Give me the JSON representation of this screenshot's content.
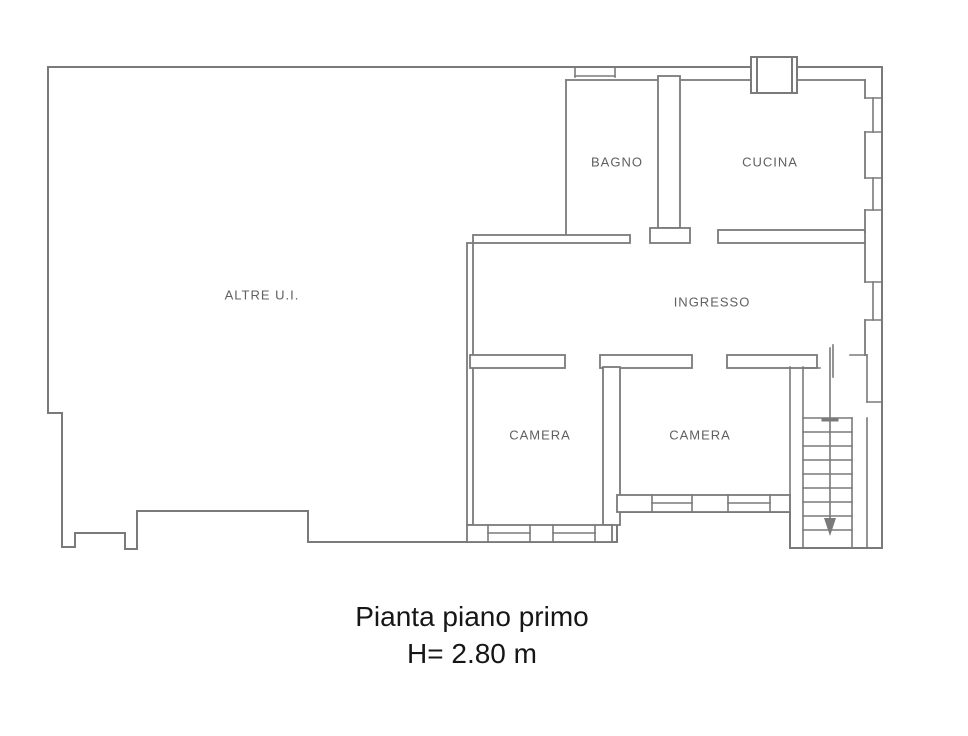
{
  "floor_plan": {
    "rooms": [
      {
        "name": "altre-ui",
        "label": "ALTRE U.I."
      },
      {
        "name": "bagno",
        "label": "BAGNO"
      },
      {
        "name": "cucina",
        "label": "CUCINA"
      },
      {
        "name": "ingresso",
        "label": "INGRESSO"
      },
      {
        "name": "camera-left",
        "label": "CAMERA"
      },
      {
        "name": "camera-right",
        "label": "CAMERA"
      }
    ],
    "caption": {
      "title": "Pianta piano primo",
      "height_note": "H= 2.80 m"
    },
    "colors": {
      "wall_line": "#7a7a7a",
      "room_label": "#606060",
      "caption_text": "#161616",
      "background": "#ffffff"
    }
  }
}
